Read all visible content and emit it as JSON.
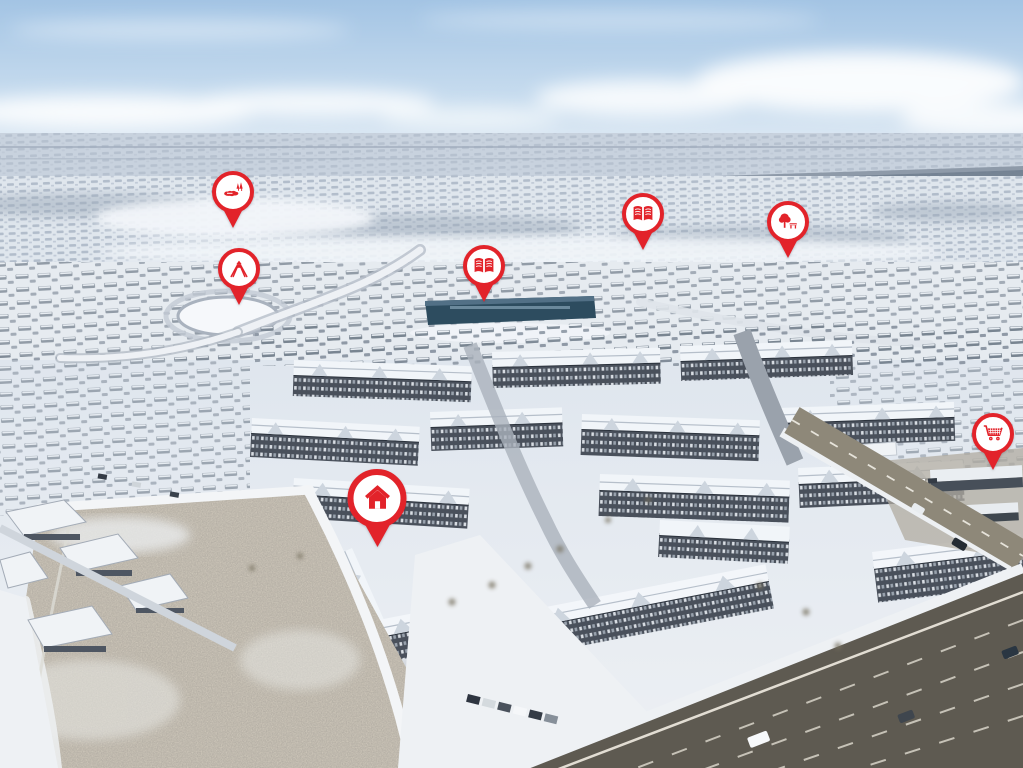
{
  "scene": {
    "type": "winter aerial photograph of a suburban neighbourhood with amenity location pins",
    "ground": "snow covered",
    "sky": "blue with clouds"
  },
  "palette": {
    "pin_red": "#e2232a",
    "pin_fill": "#ffffff",
    "sky_top": "#a3c4e4",
    "sky_horizon": "#e8eff6",
    "snow": "#eef1f5",
    "distant_suburbs": "#c8d2de",
    "school_roof": "#2d4c5f",
    "open_field": "#ccc5b8",
    "arterial_road": "#5e5a51"
  },
  "markers": [
    {
      "id": "pond-park",
      "icon": "pond-trees-icon",
      "x_pct": 22.8,
      "y_pct": 29.7,
      "size": "small"
    },
    {
      "id": "playground",
      "icon": "playground-icon",
      "x_pct": 23.4,
      "y_pct": 39.7,
      "size": "small"
    },
    {
      "id": "school-west",
      "icon": "open-book-icon",
      "x_pct": 47.3,
      "y_pct": 39.3,
      "size": "small"
    },
    {
      "id": "school-east",
      "icon": "open-book-icon",
      "x_pct": 62.9,
      "y_pct": 32.6,
      "size": "small"
    },
    {
      "id": "park",
      "icon": "tree-bench-icon",
      "x_pct": 77.0,
      "y_pct": 33.6,
      "size": "small"
    },
    {
      "id": "shopping",
      "icon": "shopping-cart-icon",
      "x_pct": 97.1,
      "y_pct": 61.2,
      "size": "small"
    },
    {
      "id": "home",
      "icon": "house-icon",
      "x_pct": 36.9,
      "y_pct": 71.2,
      "size": "large"
    }
  ]
}
